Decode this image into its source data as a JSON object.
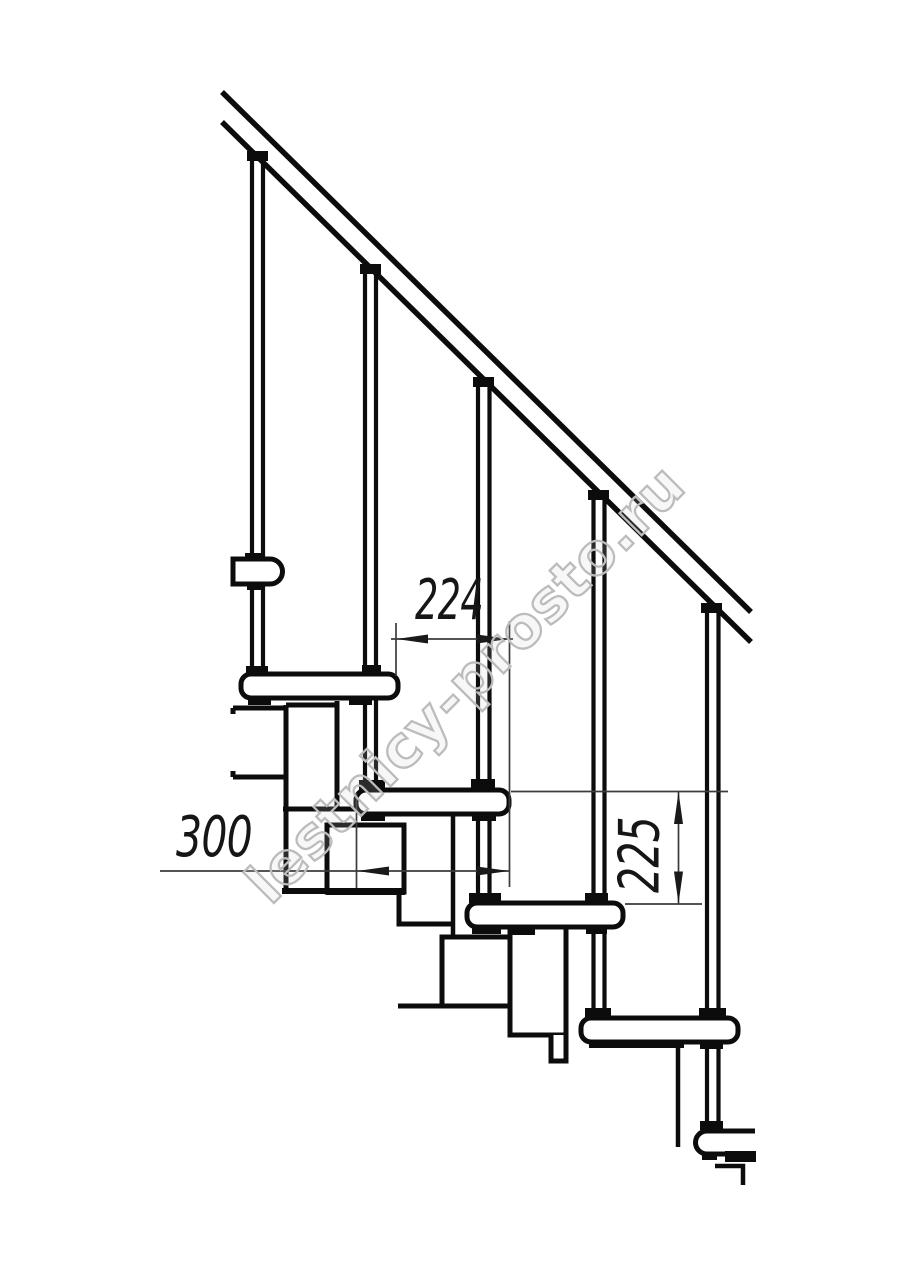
{
  "drawing": {
    "type": "technical line drawing",
    "subject": "modular staircase side elevation",
    "watermark": "lestnicy-prosto.ru",
    "dimensions": {
      "step_run_mm": "224",
      "tread_depth_mm": "300",
      "step_height_mm": "225"
    },
    "colors": {
      "line": "#0c0c0c",
      "dimension_line": "#3c3c3c",
      "watermark": "#bcbcbc",
      "background": "#ffffff"
    }
  }
}
